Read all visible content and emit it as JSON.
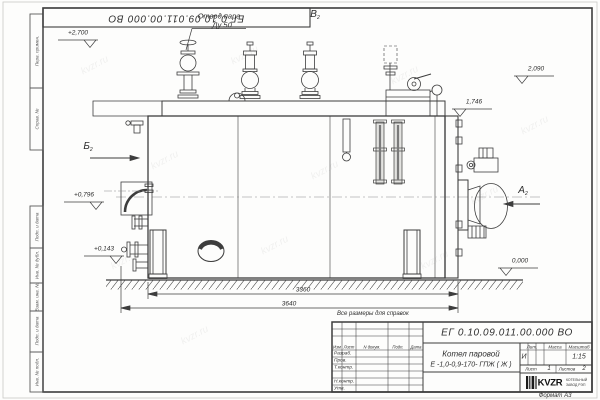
{
  "watermark": "kvzr.ru",
  "corner_stamp": {
    "designation": "ЕГ 0.10.09.011.00.000  ВО"
  },
  "frame_stamps": {
    "items": [
      "Перв. примен.",
      "Справ. №",
      "Подп. и дата",
      "Инв. № дубл.",
      "Взам. инв. №",
      "Подп. и дата",
      "Инв. № подл."
    ]
  },
  "annotations": {
    "steam_outlet_line1": "Отвод пара",
    "steam_outlet_line2": "Ду 50",
    "view_a": "А",
    "view_b": "Б",
    "view_v": "В",
    "view_sheet_ref": "2",
    "note": "Все размеры для справок",
    "elev_2700": "+2,700",
    "elev_2090": "2,090",
    "elev_1746": "1,746",
    "elev_0796": "+0,796",
    "elev_0143": "+0,143",
    "elev_0000": "0,000",
    "dim_3360": "3360",
    "dim_3640": "3640"
  },
  "title_block": {
    "designation": "ЕГ 0.10.09.011.00.000  ВО",
    "product_name": "Котел паровой",
    "product_type": "Е -1,0-0,9-170- ГПЖ ( Ж )",
    "cols": {
      "izm": "Изм",
      "list": "Лист",
      "doc": "N докум.",
      "sign": "Подп.",
      "date": "Дата"
    },
    "rows": {
      "razrab": "Разраб.",
      "prov": "Пров.",
      "tkontr": "Т.контр.",
      "nkontr": "Н.контр.",
      "utv": "Утв."
    },
    "lit_label": "Лит.",
    "mass_label": "Масса",
    "scale_label": "Масштаб",
    "lit_value": "И",
    "scale_value": "1:15",
    "sheet_label": "Лист",
    "sheet_number": "1",
    "sheets_label": "Листов",
    "sheets_total": "2",
    "logo": {
      "name": "KVZR",
      "line1": "КОТЕЛЬНЫЙ",
      "line2": "ЗАВОД РЭП"
    },
    "format_label": "Формат А3"
  }
}
